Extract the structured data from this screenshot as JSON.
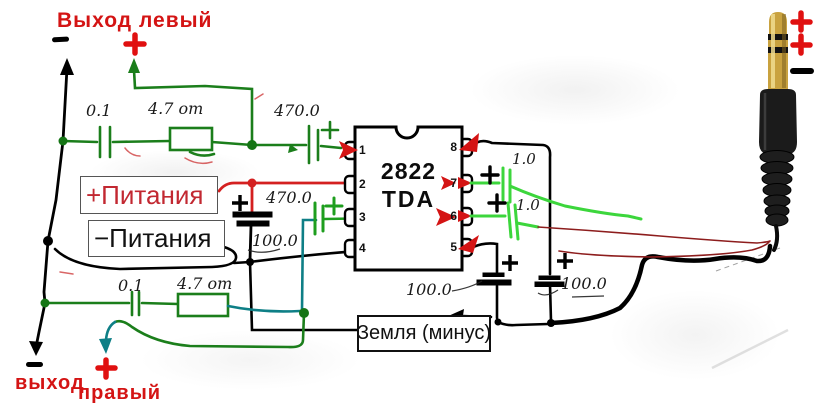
{
  "labels": {
    "out_left_title": "Выход левый",
    "out_right_line1": "выход",
    "out_right_line2": "правый",
    "power_plus": "+Питания",
    "power_minus": "−Питания",
    "ground": "Земля (минус)"
  },
  "ic": {
    "name_line1": "2822",
    "name_line2": "TDA",
    "pins_left": [
      "1",
      "2",
      "3",
      "4"
    ],
    "pins_right": [
      "8",
      "7",
      "6",
      "5"
    ]
  },
  "values": {
    "cap_in_top": "0.1",
    "res_top": "4.7 om",
    "cap_out_top": "470.0",
    "cap_mid": "470.0",
    "cap_power": "100.0",
    "cap_pin7": "1.0",
    "cap_pin6": "1.0",
    "cap_gnd_left": "100.0",
    "cap_gnd_right": "100.0",
    "cap_in_bottom": "0.1",
    "res_bottom": "4.7 om"
  },
  "marks": {
    "left_output_plus": "+",
    "left_output_minus": "−",
    "right_output_plus": "+",
    "right_output_minus": "−",
    "jack_tip_plus": "+",
    "jack_ring_plus": "+",
    "jack_sleeve_minus": "−"
  },
  "colors": {
    "wire_dark_green": "#1b7e1b",
    "wire_bright_green": "#3cd63c",
    "wire_teal": "#0e7f86",
    "wire_red": "#d42020",
    "wire_thin_red": "#8d1d1d",
    "wire_black": "#000000",
    "label_red": "#d41414",
    "jack_gold": "#c9a23f",
    "jack_body": "#1b1b1b"
  }
}
